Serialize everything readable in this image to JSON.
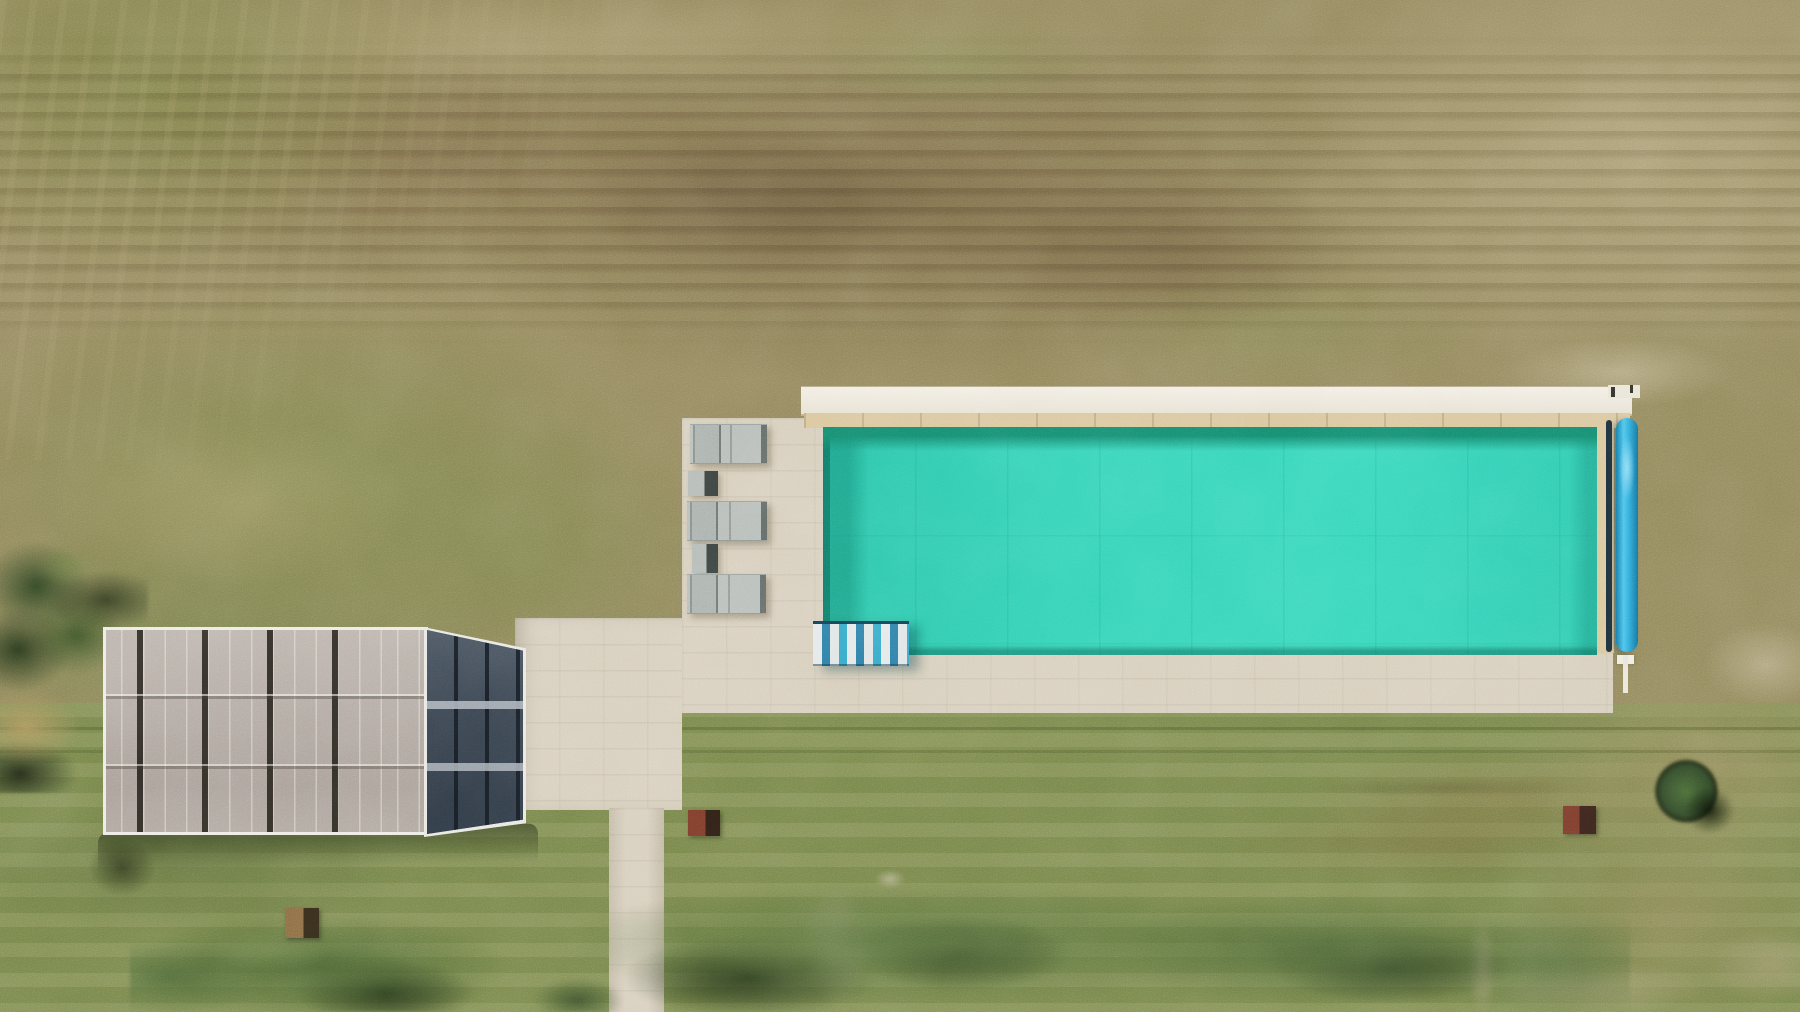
{
  "scene": {
    "description": "Top-down aerial drone photo of a long rectangular turquoise swimming pool with a beige stone deck set in a large patchy grass field",
    "objects": {
      "pool": "long rectangular pool with bright turquoise water, dark shadow along its left and top inside edges",
      "pool_steps": "blue and white striped entry steps at the pool's bottom-left corner",
      "pool_cover_roller": "bright blue cylindrical cover roller along the pool's right edge",
      "coping": "white stone coping band along the far (top) edge with a sand-colored strip beneath it",
      "deck": "beige paved sunbathing deck left of and below the pool",
      "sun_loungers": "three grey sun loungers in a column on the left deck",
      "side_tables": "two small grey side tables between the loungers",
      "pool_house": "flat-roofed pool house with grey ribbed roof panels and a dark glass section on its right",
      "patio": "paved patio connecting pool house to deck",
      "footpath": "straight concrete footpath running to the bottom edge",
      "hedge": "irregular hedge row along the bottom with dark shadow patches",
      "tree": "dark green tree with dry brush at the left edge",
      "round_bush": "small round dark bush on rough grass right of the lawn",
      "planters": "three small rust-brown square planters on the lawn",
      "field": "mowed field, dead brown rows at top, green lawn below"
    },
    "counts": {
      "sun_loungers": 3,
      "side_tables": 2,
      "planters": 3,
      "trees": 1,
      "round_bushes": 1
    }
  },
  "palette": {
    "water": "#35d1b5",
    "water_edge": "#157e66",
    "coping": "#efeadd",
    "paving": "#d7cebc",
    "sand_strip": "#d9c69c",
    "roller_blue": "#3eb9e6",
    "roof_panel": "#b5aca5",
    "roof_frame": "#ecebe5",
    "glass": "#39434f",
    "lounger_grey": "#b7bdb9",
    "steps_blue": "#2e7ca6",
    "steps_white": "#e3e8e8",
    "field_tan": "#93875d",
    "field_brown": "#77634a",
    "lawn_green": "#7b894e",
    "hedge_green": "#567242",
    "tree_green": "#3c5a30",
    "planter_rust": "#7b3b2b"
  }
}
